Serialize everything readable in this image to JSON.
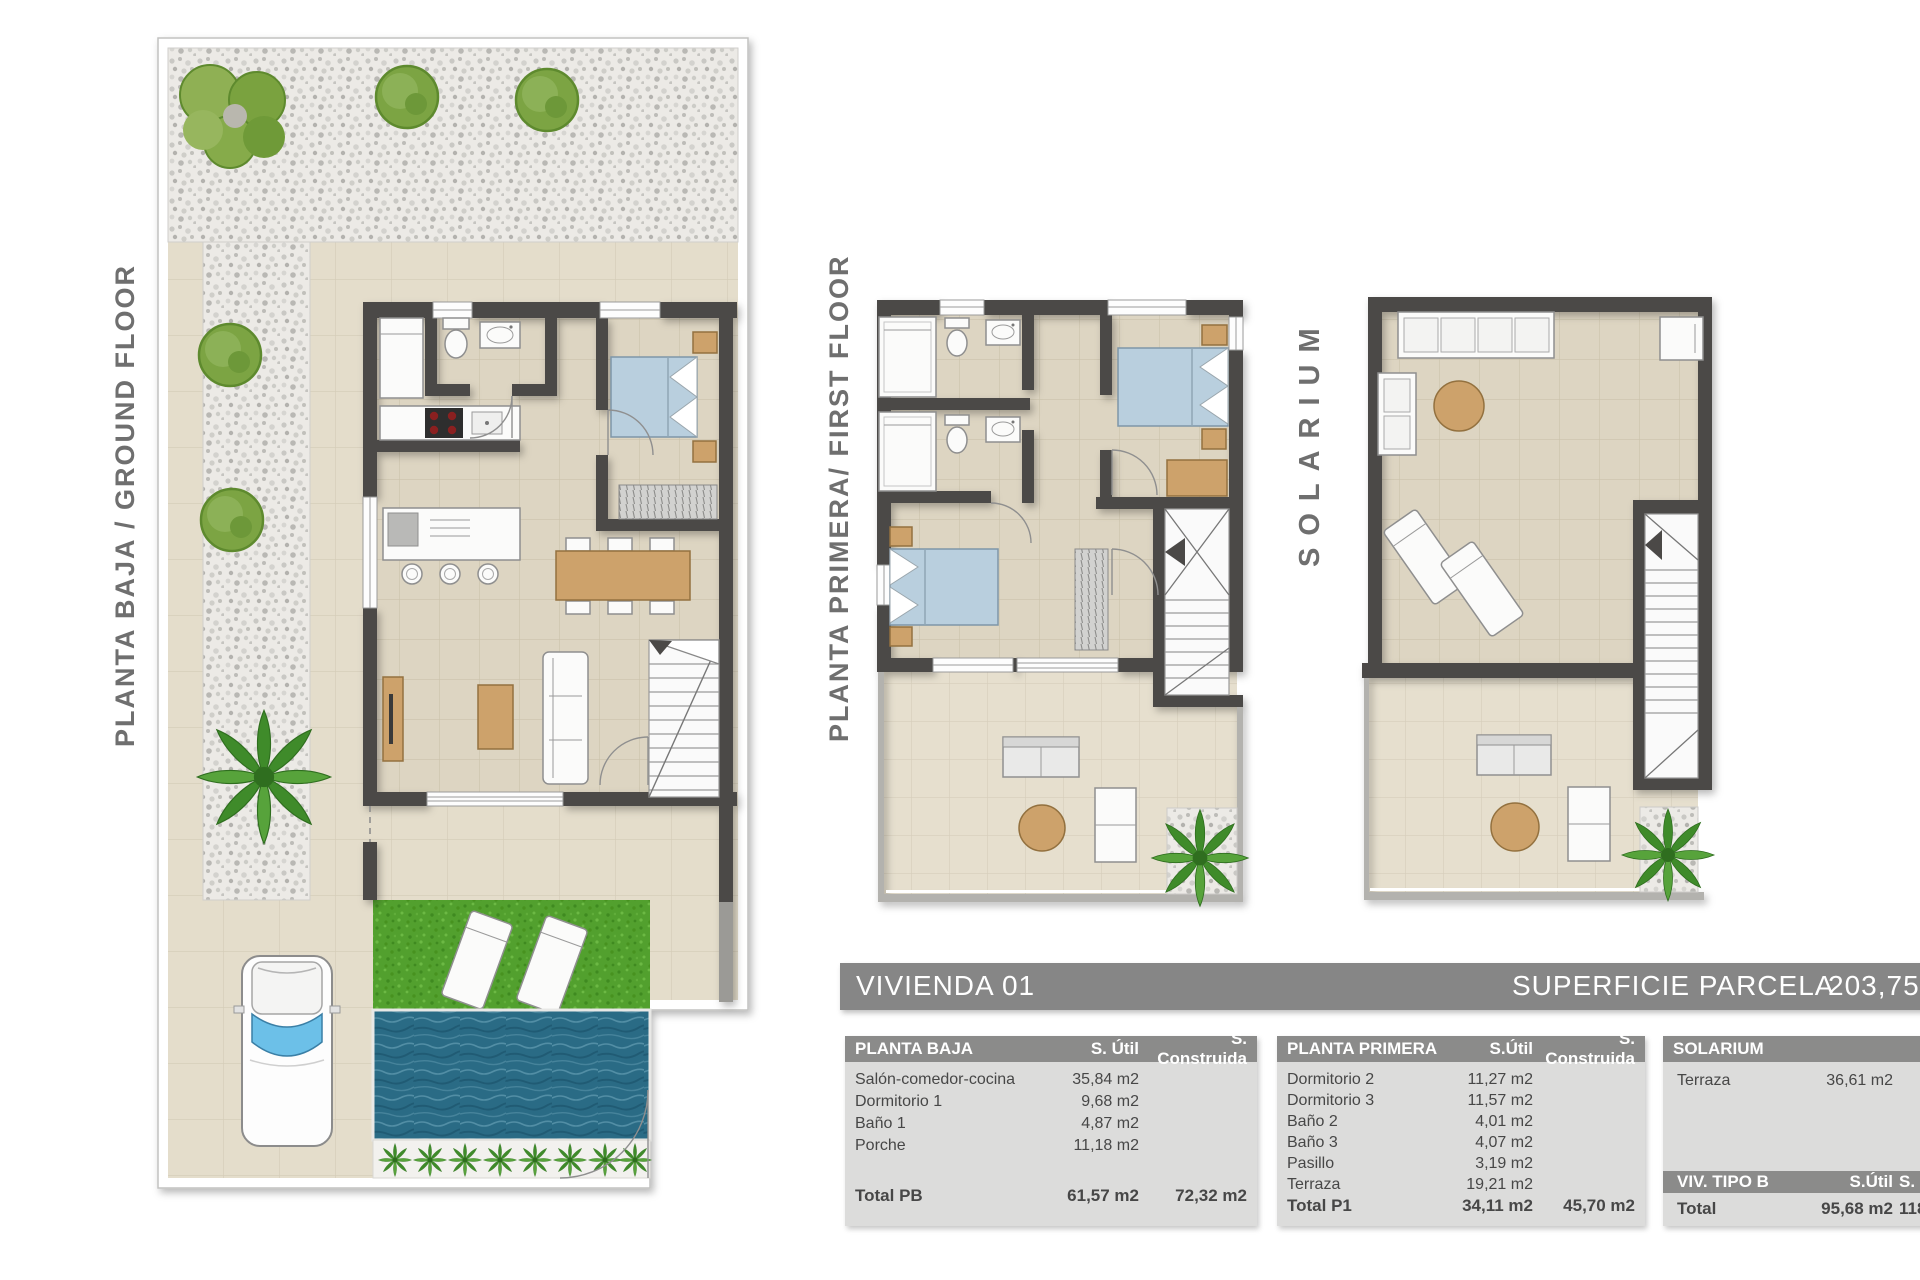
{
  "plans": {
    "ground_floor": {
      "label": "PLANTA BAJA / GROUND FLOOR"
    },
    "first_floor": {
      "label": "PLANTA PRIMERA/ FIRST FLOOR"
    },
    "solarium": {
      "label": "SOLARIUM"
    }
  },
  "header_bar": {
    "title": "VIVIENDA 01",
    "parcel_label": "SUPERFICIE PARCELA",
    "parcel_value": "203,75m2"
  },
  "tables": {
    "planta_baja": {
      "title": "PLANTA BAJA",
      "col_util": "S. Útil",
      "col_construida": "S. Construida",
      "rows": [
        {
          "label": "Salón-comedor-cocina",
          "util": "35,84 m2",
          "construida": ""
        },
        {
          "label": "Dormitorio 1",
          "util": "9,68 m2",
          "construida": ""
        },
        {
          "label": "Baño 1",
          "util": "4,87 m2",
          "construida": ""
        },
        {
          "label": "Porche",
          "util": "11,18 m2",
          "construida": ""
        }
      ],
      "total": {
        "label": "Total PB",
        "util": "61,57 m2",
        "construida": "72,32 m2"
      }
    },
    "planta_primera": {
      "title": "PLANTA PRIMERA",
      "col_util": "S.Útil",
      "col_construida": "S. Construida",
      "rows": [
        {
          "label": "Dormitorio 2",
          "util": "11,27 m2",
          "construida": ""
        },
        {
          "label": "Dormitorio 3",
          "util": "11,57 m2",
          "construida": ""
        },
        {
          "label": "Baño 2",
          "util": "4,01 m2",
          "construida": ""
        },
        {
          "label": "Baño 3",
          "util": "4,07 m2",
          "construida": ""
        },
        {
          "label": "Pasillo",
          "util": "3,19 m2",
          "construida": ""
        },
        {
          "label": "Terraza",
          "util": "19,21 m2",
          "construida": ""
        }
      ],
      "total": {
        "label": "Total P1",
        "util": "34,11 m2",
        "construida": "45,70 m2"
      }
    },
    "solarium": {
      "title": "SOLARIUM",
      "rows": [
        {
          "label": "Terraza",
          "util": "36,61 m2"
        }
      ]
    },
    "viv_tipo_b": {
      "title": "VIV. TIPO B",
      "col_util": "S.Útil",
      "col_construida": "S. Construida",
      "total": {
        "label": "Total",
        "util": "95,68 m2",
        "construida": "118,02 m2"
      }
    }
  },
  "colors": {
    "wall": "#4b4947",
    "floor_tile": "#ddd5c2",
    "terrace_tile": "#e6dfce",
    "gravel": "#eceae6",
    "grass": "#52a02e",
    "pool_water": "#2a6b85",
    "bed_blue": "#b9cfde",
    "wood_tan": "#cda26b",
    "table_header_gray": "#8b8b8a",
    "table_body_gray": "#dcdcdb",
    "label_gray": "#6f6f6f"
  }
}
